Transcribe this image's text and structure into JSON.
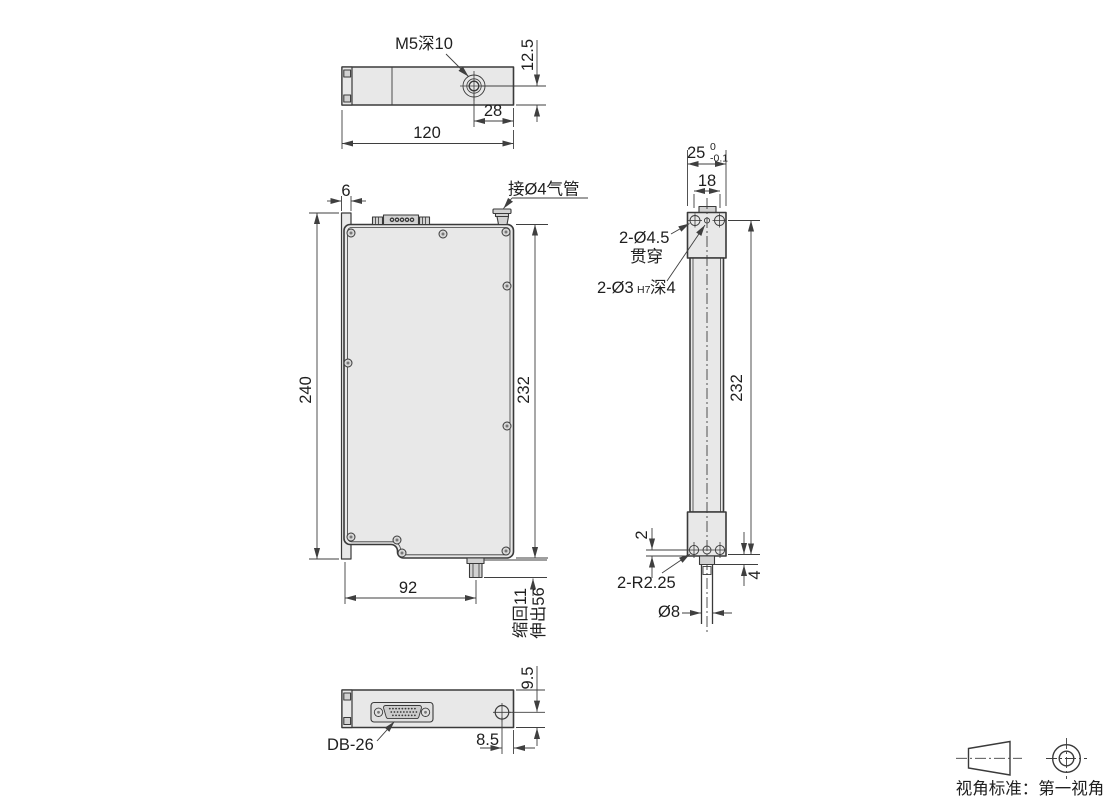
{
  "colors": {
    "line": "#3a3a3a",
    "dim": "#3f3f3f",
    "fill": "#e8e8e8",
    "fill_dark": "#d2d2d2",
    "text": "#1f1f1f",
    "bg": "#ffffff"
  },
  "views": {
    "top": {
      "labels": {
        "thread": "M5深10",
        "h12_5": "12.5",
        "w28": "28",
        "w120": "120"
      }
    },
    "front": {
      "labels": {
        "w6": "6",
        "air": "接Ø4气管",
        "h240": "240",
        "h232": "232",
        "w92": "92",
        "retract": "缩回11",
        "extend": "伸出56"
      }
    },
    "side": {
      "labels": {
        "w25": "25",
        "tol_up": "0",
        "tol_dn": "-0.1",
        "w18": "18",
        "holes_qty": "2-Ø4.5",
        "holes_note": "贯穿",
        "dowel_a": "2-Ø3",
        "dowel_b": "H7",
        "dowel_c": "深4",
        "h232": "232",
        "off2": "2",
        "radius": "2-R2.25",
        "off4": "4",
        "rod_dia": "Ø8"
      }
    },
    "bottom": {
      "labels": {
        "h9_5": "9.5",
        "conn": "DB-26",
        "w8_5": "8.5"
      }
    }
  },
  "projection": {
    "label": "视角标准：第一视角"
  }
}
